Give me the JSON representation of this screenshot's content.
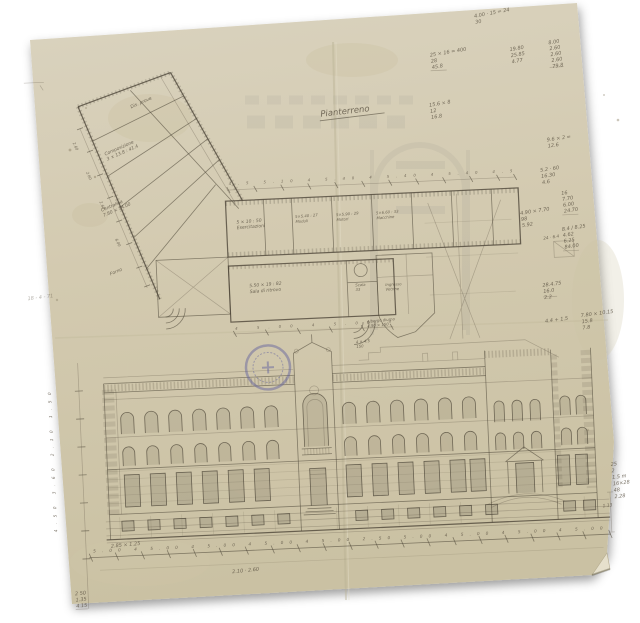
{
  "colors": {
    "paper": "#d6ceb4",
    "ink": "#4e4739",
    "stamp": "#5c5c9e"
  },
  "drawing": {
    "title": "Pianterreno",
    "date_note": "18 - 4 - 71",
    "plan": {
      "top_dims": "4.5 5.10 4 5.40 4 5.40 4 5.40 4.5",
      "mid_dims": "4 5.00 4 5.00 4",
      "edge_dims": [
        "2.60",
        "2.60",
        "2.60",
        "6.00"
      ],
      "rooms": [
        {
          "lines": [
            "Dis. prove"
          ]
        },
        {
          "lines": [
            "Composizione",
            "3 × 13.8 : 41.4"
          ]
        },
        {
          "lines": [
            "Centralina",
            "7.80 × 14.00"
          ]
        },
        {
          "lines": [
            "Forno"
          ]
        },
        {
          "lines": [
            "5 × 10 : 50",
            "Esercitazioni"
          ]
        },
        {
          "lines": [
            "5×5.40 : 27",
            "Moduli"
          ]
        },
        {
          "lines": [
            "5×5.90 : 29",
            "Motori"
          ]
        },
        {
          "lines": [
            "5×6.60 : 33",
            "Macchine"
          ]
        },
        {
          "lines": [
            "5.50 × 19 : 82",
            "Sala di ritrovo"
          ]
        },
        {
          "lines": [
            "Ingresso",
            "Vetrine"
          ]
        },
        {
          "lines": [
            "Scala",
            "33"
          ]
        },
        {
          "lines": [
            "Albergo diurno",
            "4.50 × 150"
          ]
        },
        {
          "lines": [
            "24 · 6.4"
          ]
        }
      ]
    },
    "elevation": {
      "bottom_dims": "5.00 4 5.00 4 5.00 4 5.00 4 5.00 2.50 5.00 4 5.00 4 5.00 4 5.00",
      "left_heights": "4.50 3.60 2.10 1.50"
    },
    "calcs": [
      {
        "lines": [
          "4.00 · 15 = 24",
          "30"
        ]
      },
      {
        "lines": [
          "25 × 16 = 400",
          "28",
          "45.8"
        ]
      },
      {
        "lines": [
          "19.80",
          "25.85",
          "4.77"
        ]
      },
      {
        "lines": [
          "8.00",
          "2.60",
          "2.60",
          "2.60",
          "79.8"
        ]
      },
      {
        "lines": [
          "15.6 × 8",
          "12",
          "16.8"
        ]
      },
      {
        "lines": [
          "9.6 × 2 =",
          "12.6"
        ]
      },
      {
        "lines": [
          "5.2 · 60",
          "16.30",
          "4.6"
        ]
      },
      {
        "lines": [
          "16",
          "7.70",
          "6.00",
          "24.70"
        ]
      },
      {
        "lines": [
          "4.90 × 7.70",
          "98",
          "5.92"
        ]
      },
      {
        "lines": [
          "8.4 / 8.25",
          "4.62",
          "6.25",
          "84.00"
        ]
      },
      {
        "lines": [
          "28.4.75",
          "16.0",
          "2.2"
        ]
      },
      {
        "lines": [
          "4.4 + 1.5"
        ]
      },
      {
        "lines": [
          "7.80 × 10.15",
          "15.8",
          "7.8"
        ]
      },
      {
        "lines": [
          "25",
          "2",
          "1.5 m",
          "16×28",
          "48",
          "2.28"
        ]
      },
      {
        "lines": [
          "2 50",
          "1.35",
          "4.15"
        ]
      },
      {
        "lines": [
          "2.85 × 1.25"
        ]
      },
      {
        "lines": [
          "2.10 · 2.60"
        ]
      },
      {
        "lines": [
          "1.13"
        ]
      },
      {
        "lines": [
          "4 × 4.5",
          "150"
        ]
      }
    ]
  }
}
